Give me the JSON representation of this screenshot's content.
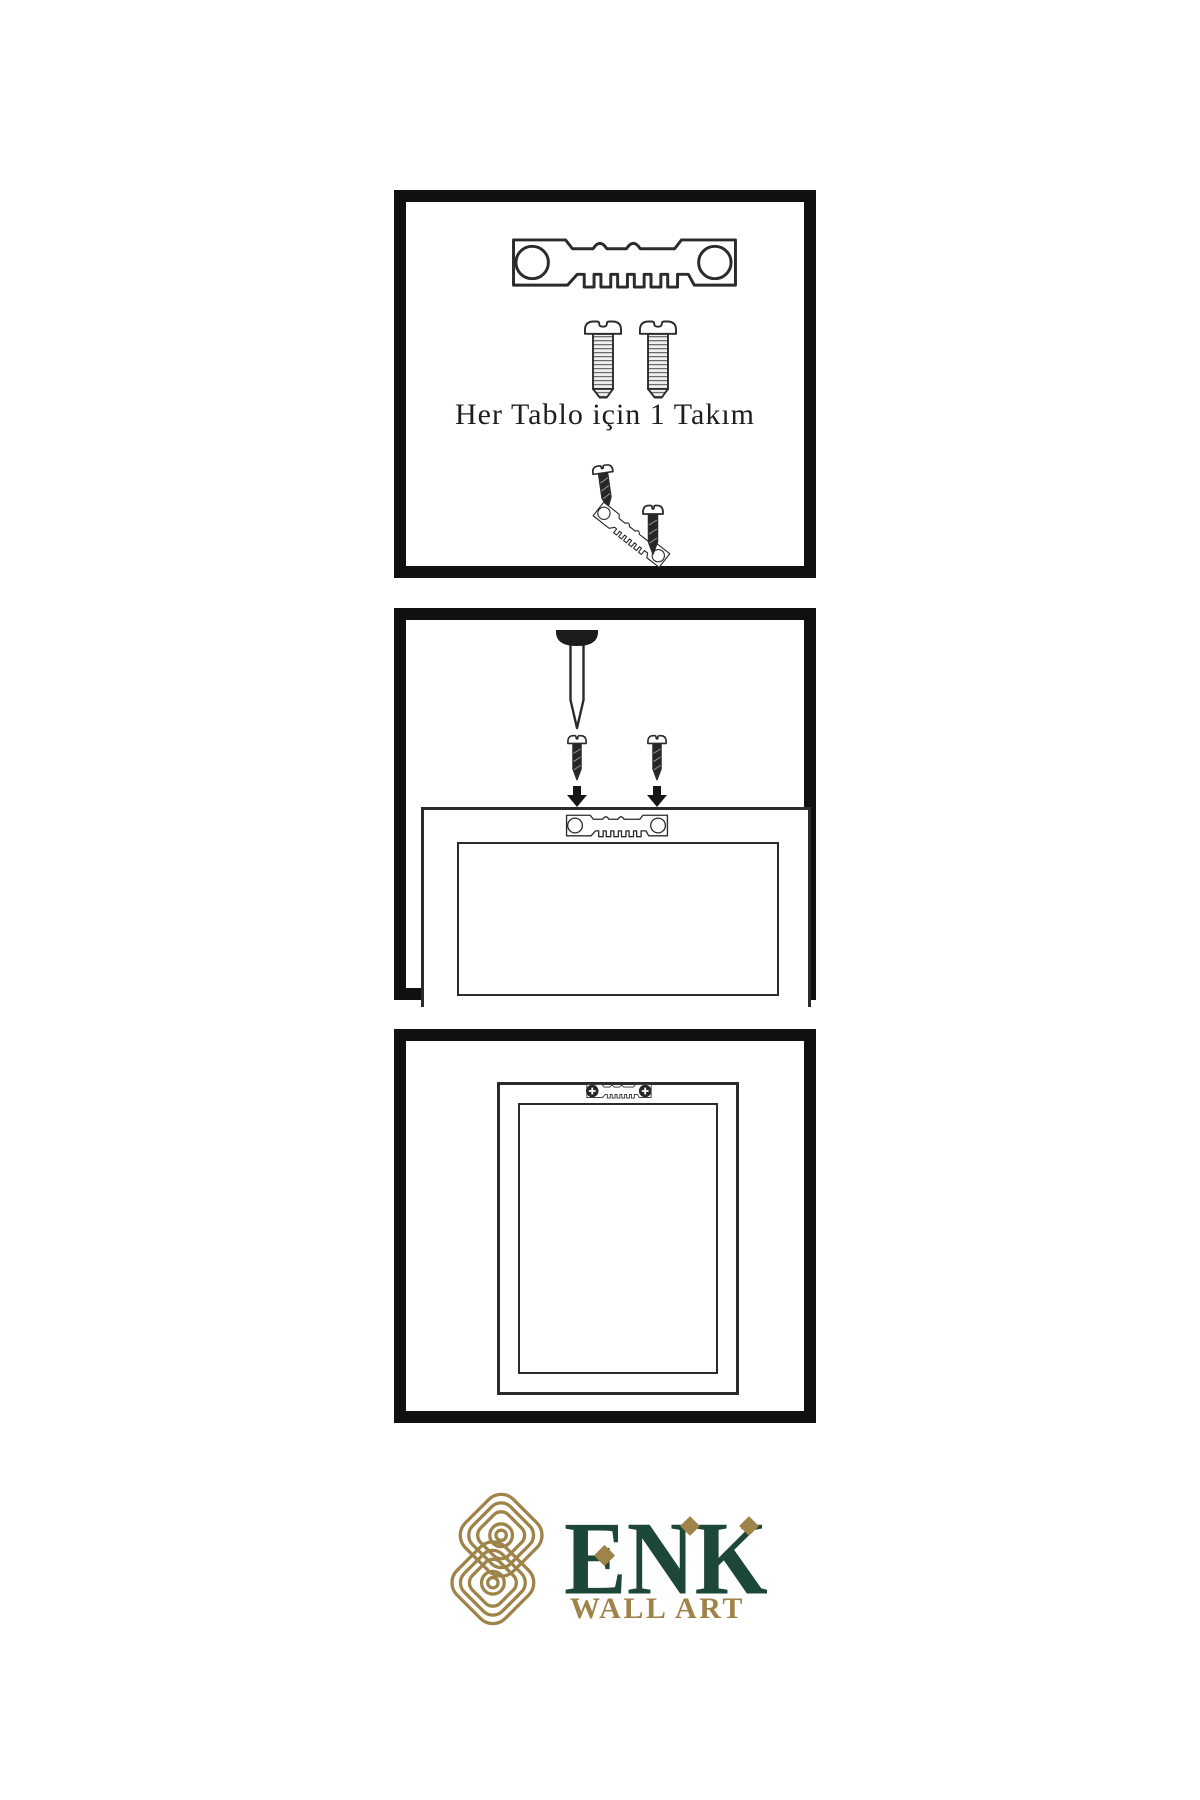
{
  "document": {
    "type": "wall-art hanging instruction sheet",
    "background": "#ffffff"
  },
  "colors": {
    "ink": "#2b2b2b",
    "panel-border": "#101010",
    "dark-fill": "#262626",
    "brand-green": "#1d4737",
    "brand-gold": "#9f8449",
    "thread-bg": "#f0f0f0",
    "thread-line": "#6a6a6a",
    "paper": "#ffffff"
  },
  "panels": {
    "kit": {
      "caption": "Her Tablo için 1 Takım"
    },
    "mount": {},
    "done": {}
  },
  "brand": {
    "wordmark": "ENK",
    "tagline": "WALL ART"
  },
  "icons": {
    "sawtooth-hanger-icon": "metal sawtooth picture hanger plate with two screw holes",
    "screw-threaded-icon": "slotted pan-head screw with threaded shaft",
    "screw-dark-icon": "small dark screw with pointed tip",
    "nail-icon": "nail driven into wall, dark head, pointed shaft",
    "arrow-down-icon": "solid downward arrow",
    "frame-back-icon": "rear view of picture frame (outer and inner rectangles)",
    "knot-monogram-icon": "interlaced gold loop knot emblem",
    "diamond-accent-icon": "gold diamond accent"
  }
}
